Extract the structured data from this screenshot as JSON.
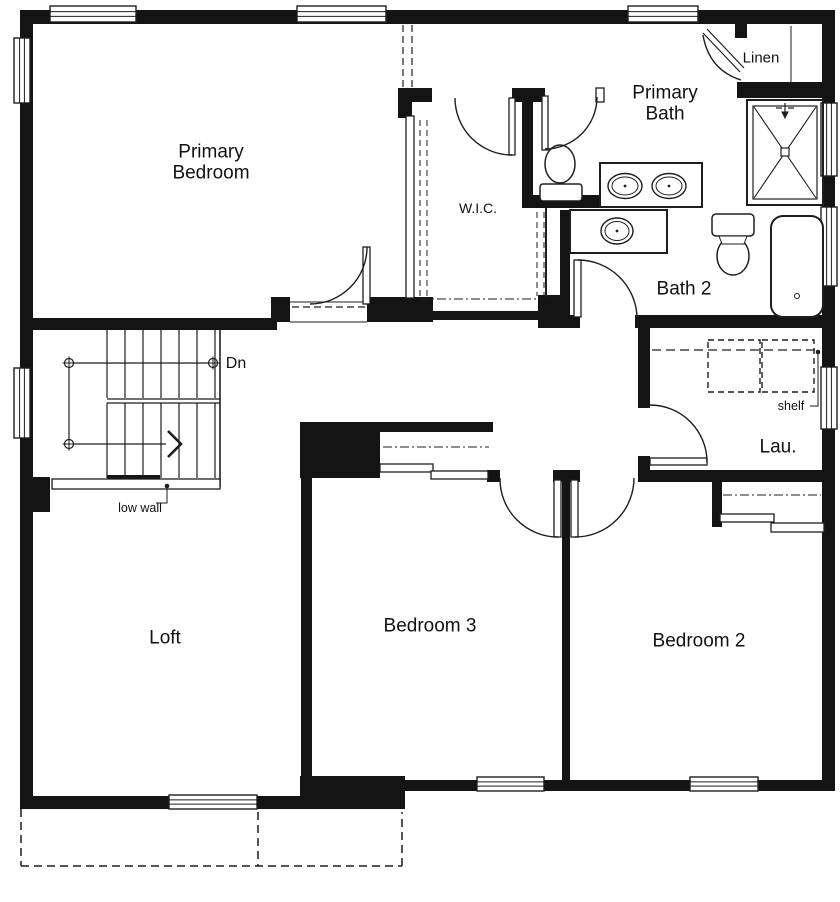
{
  "colors": {
    "wall": "#141414",
    "line": "#1e1e1e",
    "bg": "#ffffff"
  },
  "labels": [
    {
      "id": "primary-bedroom",
      "text": "Primary Bedroom",
      "x": 211,
      "y": 163,
      "fs": 19,
      "w": 100
    },
    {
      "id": "wic",
      "text": "W.I.C.",
      "x": 478,
      "y": 209,
      "fs": 14,
      "w": 60
    },
    {
      "id": "primary-bath",
      "text": "Primary Bath",
      "x": 665,
      "y": 104,
      "fs": 19,
      "w": 100
    },
    {
      "id": "linen",
      "text": "Linen",
      "x": 761,
      "y": 59,
      "fs": 15,
      "w": 60
    },
    {
      "id": "bath-2",
      "text": "Bath 2",
      "x": 684,
      "y": 289,
      "fs": 19,
      "w": 120
    },
    {
      "id": "lau",
      "text": "Lau.",
      "x": 778,
      "y": 447,
      "fs": 19,
      "w": 60
    },
    {
      "id": "loft",
      "text": "Loft",
      "x": 165,
      "y": 638,
      "fs": 19,
      "w": 80
    },
    {
      "id": "bedroom-3",
      "text": "Bedroom 3",
      "x": 430,
      "y": 626,
      "fs": 19,
      "w": 160
    },
    {
      "id": "bedroom-2",
      "text": "Bedroom 2",
      "x": 699,
      "y": 641,
      "fs": 19,
      "w": 160
    },
    {
      "id": "dn",
      "text": "Dn",
      "x": 236,
      "y": 364,
      "fs": 16,
      "w": 40
    },
    {
      "id": "shelf",
      "text": "shelf",
      "x": 791,
      "y": 406,
      "fs": 12.5,
      "w": 40
    },
    {
      "id": "low-wall",
      "text": "low wall",
      "x": 140,
      "y": 508,
      "fs": 12.5,
      "w": 44
    }
  ],
  "geometry": {
    "walls": [
      [
        20,
        10,
        815,
        14
      ],
      [
        20,
        10,
        13,
        790
      ],
      [
        822,
        14,
        13,
        768
      ],
      [
        735,
        10,
        12,
        28
      ],
      [
        737,
        82,
        86,
        16
      ],
      [
        300,
        780,
        535,
        11
      ],
      [
        20,
        796,
        282,
        13
      ],
      [
        300,
        776,
        105,
        33
      ],
      [
        20,
        318,
        257,
        12
      ],
      [
        271,
        297,
        19,
        25
      ],
      [
        367,
        297,
        66,
        25
      ],
      [
        430,
        311,
        112,
        9
      ],
      [
        538,
        295,
        32,
        27
      ],
      [
        398,
        88,
        14,
        30
      ],
      [
        398,
        88,
        34,
        14
      ],
      [
        512,
        88,
        33,
        14
      ],
      [
        522,
        90,
        11,
        118
      ],
      [
        522,
        195,
        80,
        13
      ],
      [
        560,
        210,
        10,
        88
      ],
      [
        538,
        315,
        42,
        13
      ],
      [
        635,
        315,
        200,
        13
      ],
      [
        638,
        315,
        12,
        93
      ],
      [
        638,
        456,
        12,
        18
      ],
      [
        638,
        470,
        197,
        12
      ],
      [
        712,
        472,
        10,
        55
      ],
      [
        380,
        422,
        113,
        10
      ],
      [
        300,
        422,
        80,
        56
      ],
      [
        301,
        478,
        11,
        300
      ],
      [
        562,
        478,
        8,
        302
      ],
      [
        553,
        470,
        27,
        12
      ],
      [
        487,
        470,
        13,
        12
      ],
      [
        20,
        477,
        30,
        35
      ],
      [
        107,
        475,
        53,
        7
      ]
    ],
    "windows": [
      [
        50,
        6,
        86,
        16,
        "h"
      ],
      [
        297,
        6,
        89,
        16,
        "h"
      ],
      [
        628,
        6,
        70,
        16,
        "h"
      ],
      [
        14,
        38,
        16,
        65,
        "v"
      ],
      [
        14,
        368,
        16,
        70,
        "v"
      ],
      [
        821,
        103,
        16,
        73,
        "v"
      ],
      [
        821,
        207,
        16,
        79,
        "v"
      ],
      [
        821,
        367,
        16,
        62,
        "v"
      ],
      [
        477,
        777,
        67,
        14,
        "h"
      ],
      [
        690,
        777,
        68,
        14,
        "h"
      ],
      [
        169,
        795,
        88,
        14,
        "h"
      ]
    ],
    "thin_rects": [
      [
        363,
        247,
        7,
        57
      ],
      [
        509,
        98,
        6,
        57
      ],
      [
        542,
        96,
        6,
        54
      ],
      [
        574,
        260,
        7,
        57
      ],
      [
        650,
        458,
        57,
        7
      ],
      [
        554,
        480,
        7,
        57
      ],
      [
        571,
        480,
        7,
        57
      ],
      [
        406,
        116,
        8,
        182
      ],
      [
        596,
        88,
        8,
        14
      ],
      [
        380,
        464,
        53,
        8
      ],
      [
        431,
        471,
        57,
        8
      ],
      [
        720,
        514,
        54,
        8
      ],
      [
        771,
        523,
        53,
        9
      ],
      [
        52,
        479,
        168,
        10
      ]
    ],
    "lines": [
      [
        107,
        330,
        107,
        398,
        1.2
      ],
      [
        125,
        330,
        125,
        398,
        1.2
      ],
      [
        143,
        330,
        143,
        398,
        1.2
      ],
      [
        161,
        330,
        161,
        398,
        1.2
      ],
      [
        179,
        330,
        179,
        398,
        1.2
      ],
      [
        197,
        330,
        197,
        398,
        1.2
      ],
      [
        215,
        330,
        215,
        398,
        1.2
      ],
      [
        107,
        403,
        107,
        478,
        1.2
      ],
      [
        125,
        403,
        125,
        478,
        1.2
      ],
      [
        143,
        403,
        143,
        478,
        1.2
      ],
      [
        161,
        403,
        161,
        478,
        1.2
      ],
      [
        179,
        403,
        179,
        478,
        1.2
      ],
      [
        197,
        403,
        197,
        478,
        1.2
      ],
      [
        215,
        403,
        215,
        478,
        1.2
      ],
      [
        107,
        399,
        220,
        399,
        1.2
      ],
      [
        107,
        403,
        220,
        403,
        1.2
      ],
      [
        220,
        330,
        220,
        487,
        1.6
      ],
      [
        73.5,
        363,
        208.5,
        363,
        1.2
      ],
      [
        69,
        367.5,
        69,
        439.5,
        1.2
      ],
      [
        73.5,
        444,
        166,
        444,
        1.2
      ],
      [
        69,
        356.5,
        69,
        369.5,
        1
      ],
      [
        213,
        356.5,
        213,
        369.5,
        1
      ],
      [
        69,
        437.5,
        69,
        450.5,
        1
      ],
      [
        62.5,
        363,
        75.5,
        363,
        1
      ],
      [
        206.5,
        363,
        219.5,
        363,
        1
      ],
      [
        62.5,
        444,
        75.5,
        444,
        1
      ],
      [
        754,
        107,
        816,
        198,
        1.1
      ],
      [
        816,
        107,
        754,
        198,
        1.1
      ],
      [
        776,
        108,
        782,
        108,
        1.2
      ],
      [
        788,
        108,
        794,
        108,
        1.2
      ],
      [
        785,
        103,
        785,
        112,
        1.2
      ],
      [
        791,
        309,
        797,
        303,
        1
      ],
      [
        803,
        309,
        797,
        303,
        1
      ],
      [
        546,
        208,
        546,
        297,
        2
      ],
      [
        290,
        302,
        367,
        302,
        1
      ],
      [
        290,
        322,
        367,
        322,
        1
      ],
      [
        791,
        26,
        791,
        82,
        1
      ],
      [
        703,
        33,
        740,
        72,
        1.2
      ],
      [
        707,
        29,
        744,
        68,
        1.2
      ]
    ],
    "dashed": [
      [
        403,
        25,
        403,
        87,
        1.2,
        "7,4"
      ],
      [
        412,
        25,
        412,
        87,
        1.2,
        "7,4"
      ],
      [
        292,
        307,
        365,
        307,
        1.2,
        "7,4"
      ],
      [
        420,
        120,
        420,
        296,
        1,
        "6,4"
      ],
      [
        427,
        120,
        427,
        296,
        1,
        "6,4"
      ],
      [
        537,
        212,
        537,
        296,
        1,
        "6,4"
      ],
      [
        544,
        212,
        544,
        296,
        1,
        "6,4"
      ],
      [
        420,
        299,
        544,
        299,
        1,
        "9,3,2,3"
      ],
      [
        383,
        447,
        489,
        447,
        1,
        "9,3,2,3"
      ],
      [
        723,
        495,
        821,
        495,
        1,
        "9,3,2,3"
      ],
      [
        652,
        350,
        820,
        350,
        1.2,
        "9,5"
      ],
      [
        21,
        809,
        21,
        866,
        1.5,
        "8,5"
      ],
      [
        21,
        866,
        402,
        866,
        1.5,
        "8,5"
      ],
      [
        402,
        866,
        402,
        812,
        1.5,
        "8,5"
      ],
      [
        258,
        812,
        258,
        866,
        1.5,
        "8,5"
      ]
    ],
    "orects": [
      [
        747,
        100,
        76,
        105,
        2,
        0,
        0
      ],
      [
        753,
        106,
        64,
        93,
        1.2,
        0,
        0
      ],
      [
        781,
        148,
        8,
        8,
        1.2,
        0,
        1
      ],
      [
        771,
        216,
        52,
        101,
        2,
        12,
        1
      ],
      [
        712,
        214,
        42,
        22,
        1.5,
        4,
        1
      ],
      [
        540,
        184,
        42,
        17,
        1.5,
        3,
        1
      ],
      [
        600,
        163,
        102,
        44,
        2,
        0,
        1
      ],
      [
        570,
        210,
        97,
        43,
        2,
        0,
        1
      ]
    ],
    "ellipses": [
      [
        560,
        164,
        15,
        19,
        1.5
      ],
      [
        733,
        256,
        16,
        19,
        1.5
      ],
      [
        625,
        186,
        17,
        12.5,
        1.4
      ],
      [
        625,
        186,
        13,
        9,
        1
      ],
      [
        669,
        186,
        17,
        12.5,
        1.4
      ],
      [
        669,
        186,
        13,
        9,
        1
      ],
      [
        617,
        231,
        16,
        13,
        1.4
      ],
      [
        617,
        231,
        12,
        9.5,
        1
      ]
    ],
    "circles": [
      [
        69,
        363,
        4.5,
        1.2
      ],
      [
        213,
        363,
        4.5,
        1.2
      ],
      [
        69,
        444,
        4.5,
        1.2
      ],
      [
        797,
        296,
        2.5,
        1
      ]
    ],
    "dots": [
      [
        625,
        186,
        1.4
      ],
      [
        669,
        186,
        1.4
      ],
      [
        617,
        231,
        1.4
      ],
      [
        167,
        486,
        2.3
      ],
      [
        818,
        352,
        2.3
      ]
    ],
    "paths": [
      {
        "d": "M310,304 A57,57 0 0 0 367,247",
        "sw": 1.4
      },
      {
        "d": "M455,98 A57,57 0 0 0 512,155",
        "sw": 1.4
      },
      {
        "d": "M597,97 A52,52 0 0 1 545,149",
        "sw": 1.4
      },
      {
        "d": "M637,317 A59,59 0 0 0 578,260",
        "sw": 1.4
      },
      {
        "d": "M650,405 A57,57 0 0 1 707,462",
        "sw": 1.4
      },
      {
        "d": "M500,478 A58,58 0 0 0 558,537",
        "sw": 1.4
      },
      {
        "d": "M575,537 A59,59 0 0 0 634,478",
        "sw": 1.4
      },
      {
        "d": "M703,35 Q709,70 741,80",
        "sw": 1.4
      },
      {
        "d": "M782,112 L788,112 L785,118 Z",
        "sw": 1,
        "f": 1
      },
      {
        "d": "M719,236 L747,236 L744,244 L722,244 Z",
        "sw": 1,
        "f": 2
      },
      {
        "d": "M708,340 h52 v52 h-52 Z",
        "sw": 1.4,
        "da": "6,4"
      },
      {
        "d": "M762,340 h52 v52 h-52 Z",
        "sw": 1.4,
        "da": "6,4"
      },
      {
        "d": "M168,431 L181,444 L168,457",
        "sw": 2.6
      },
      {
        "d": "M156,503 L167,503 L167,488",
        "sw": 1
      },
      {
        "d": "M810,406 L818,406 L818,354",
        "sw": 1
      }
    ]
  }
}
